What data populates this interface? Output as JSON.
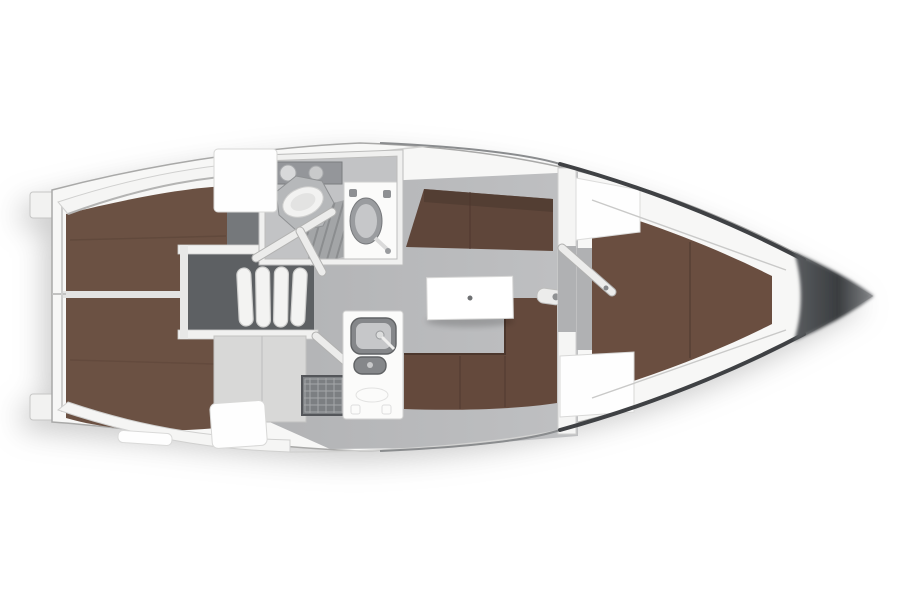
{
  "colors": {
    "background": "#ffffff",
    "hull_fill": "#f7f7f6",
    "hull_stroke": "#a9a9a8",
    "deck_band": "#f5f5f4",
    "notch_fill": "#f2f2f1",
    "sheer_light": "#8a8c8e",
    "sheer_dark": "#3f4144",
    "bow_wedge_start": "#5a5d60",
    "bow_wedge_mid": "#3a3d40",
    "bow_wedge_tip": "#85878a",
    "floor_main": "#b2b3b5",
    "floor_main_light": "#bfc0c2",
    "floor_entry": "#b0b1b3",
    "floor_head": "#c2c3c5",
    "berth_aft": "#6b5143",
    "berth_fwd": "#6a4e40",
    "berth_seam": "#563f33",
    "settee": "#64493c",
    "backrest": "#5f463a",
    "backrest_dark": "#4f3a30",
    "divider_white": "#e3e3e2",
    "engine_box": "#5d6063",
    "landing_gray": "#75787b",
    "ledge_white": "#f1f1f0",
    "tread_white": "#f3f3f2",
    "counter_gray": "#d8d8d7",
    "stove_face": "#7c7f82",
    "fixture_white": "#fbfbfa",
    "fixture_bright": "#fefefe",
    "steel_gray": "#85878a",
    "basin_inner": "#c6c7c9",
    "basin_gray": "#9a9c9f",
    "grate_gray": "#a3a5a7",
    "grate_line": "#8b8d8f",
    "shelf_gray": "#94969a",
    "toilet_base": "#b6b8ba",
    "bowl_white": "#f2f2f1",
    "table_white": "#ffffff",
    "table_dot": "#6f7173",
    "mast_white": "#ececeb",
    "shadow_soft": "rgba(0,0,0,0.18)"
  },
  "legend": [
    "stern-transom",
    "swim-step",
    "aft-cabin-port-berth",
    "aft-cabin-starboard-berth",
    "companionway-steps",
    "engine-compartment",
    "head-compartment",
    "toilet",
    "shower-grate",
    "washbasin-cabinet",
    "galley-unit",
    "galley-sink",
    "stove-burner",
    "oven-grid",
    "saloon-floor",
    "saloon-table",
    "port-settee",
    "starboard-settee",
    "mast-post",
    "forward-bulkhead",
    "cabin-door-open",
    "wardrobe",
    "forward-v-berth",
    "forward-dresser",
    "bow-wedge"
  ]
}
